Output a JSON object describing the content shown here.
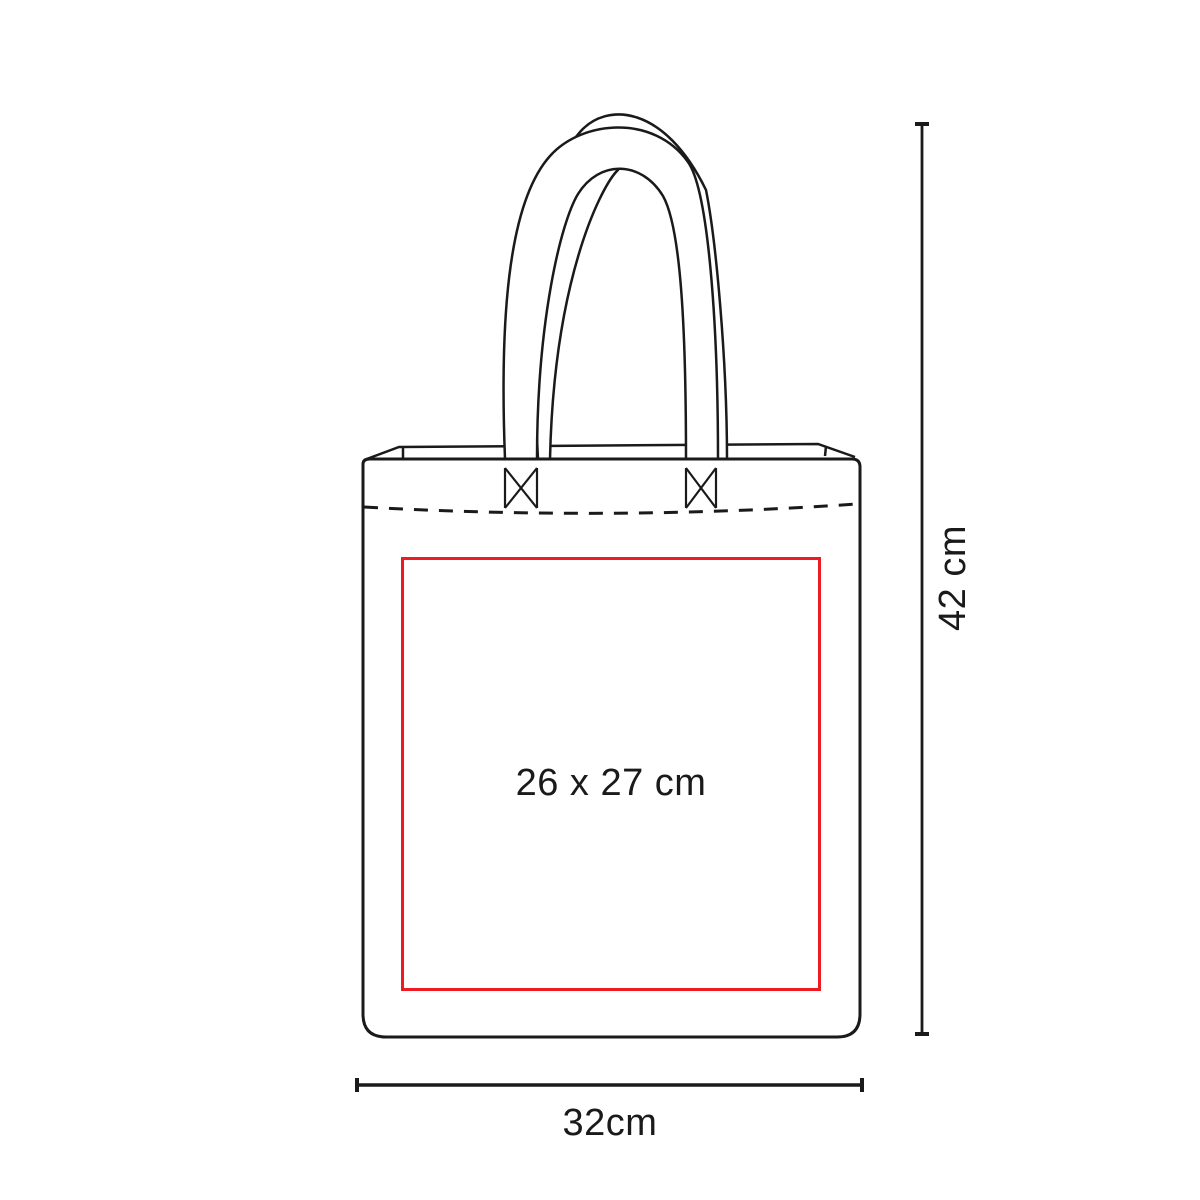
{
  "page": {
    "background": "#ffffff"
  },
  "diagram": {
    "kind": "tote-bag-dimension-diagram",
    "print_area_label": "26 x 27 cm",
    "height_label": "42 cm",
    "width_label": "32cm",
    "colors": {
      "outline": "#1a1a1a",
      "print_area": "#ee1b23",
      "text": "#1a1a1a",
      "background": "#ffffff"
    }
  }
}
